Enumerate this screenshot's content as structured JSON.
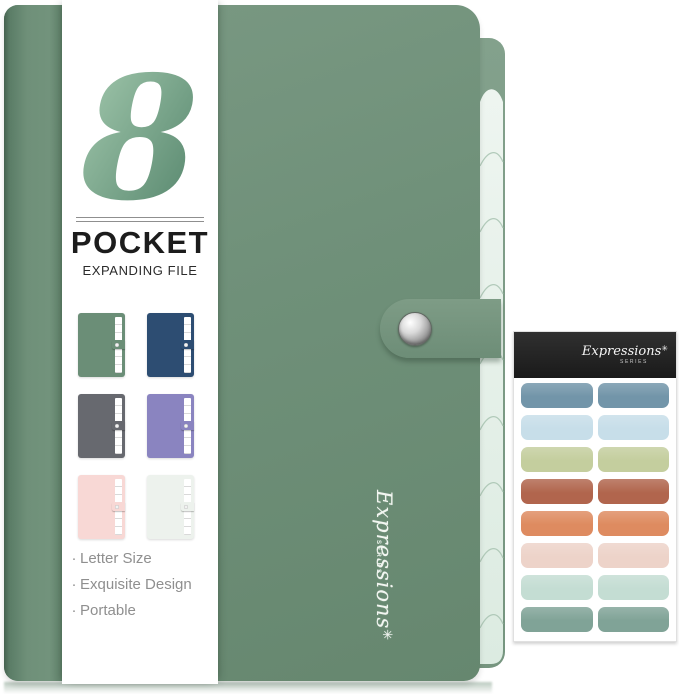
{
  "band": {
    "logo_number": "8",
    "title": "POCKET",
    "subtitle": "EXPANDING FILE",
    "bullet": "·",
    "features": [
      "Letter Size",
      "Exquisite Design",
      "Portable"
    ]
  },
  "folder": {
    "script": "Expressions",
    "star": "✳",
    "series": "SERIES",
    "color": "#6f9079",
    "tab_color": "#e5f0e8"
  },
  "swatches": [
    {
      "name": "sage-green",
      "color": "#6b8e77"
    },
    {
      "name": "navy-blue",
      "color": "#2d4d72"
    },
    {
      "name": "slate-gray",
      "color": "#67696f"
    },
    {
      "name": "lavender-purple",
      "color": "#8a84c0"
    },
    {
      "name": "blush-pink",
      "color": "#f8d8d5"
    },
    {
      "name": "mint-white",
      "color": "#edf2ed"
    }
  ],
  "sticker_sheet": {
    "script": "Expressions",
    "star": "✳",
    "series": "SERIES",
    "header_color": "#222222",
    "label_colors": [
      "#7295a9",
      "#c7dee9",
      "#c4ce9e",
      "#b1654d",
      "#de8b60",
      "#edd3c9",
      "#c4ddd3",
      "#80a397"
    ]
  }
}
